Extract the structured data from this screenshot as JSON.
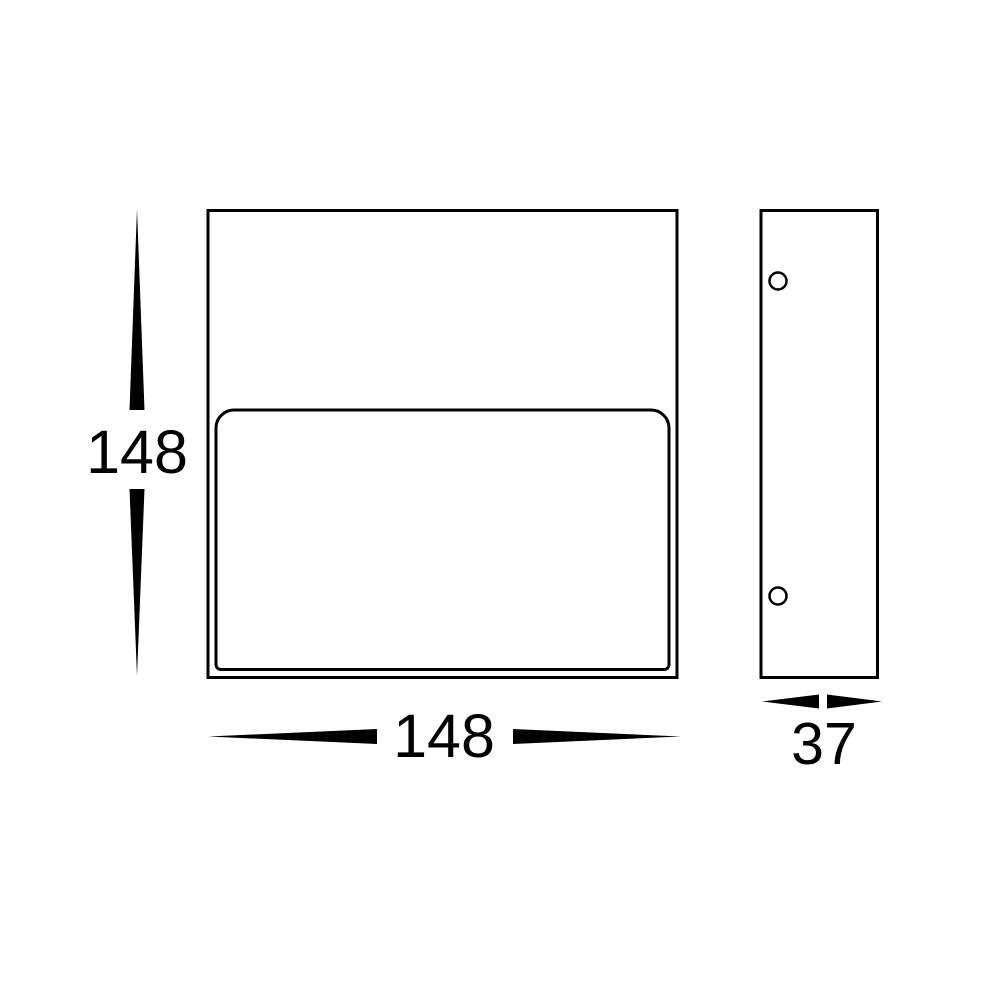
{
  "colors": {
    "line": "#000000",
    "background": "#ffffff"
  },
  "drawing": {
    "type": "technical-dimension-drawing",
    "front_view": {
      "name": "front-view",
      "height_dimension": {
        "value": "148"
      },
      "width_dimension": {
        "value": "148"
      }
    },
    "side_view": {
      "name": "side-view",
      "depth_dimension": {
        "value": "37"
      },
      "mounting_hole_count": 2
    }
  }
}
